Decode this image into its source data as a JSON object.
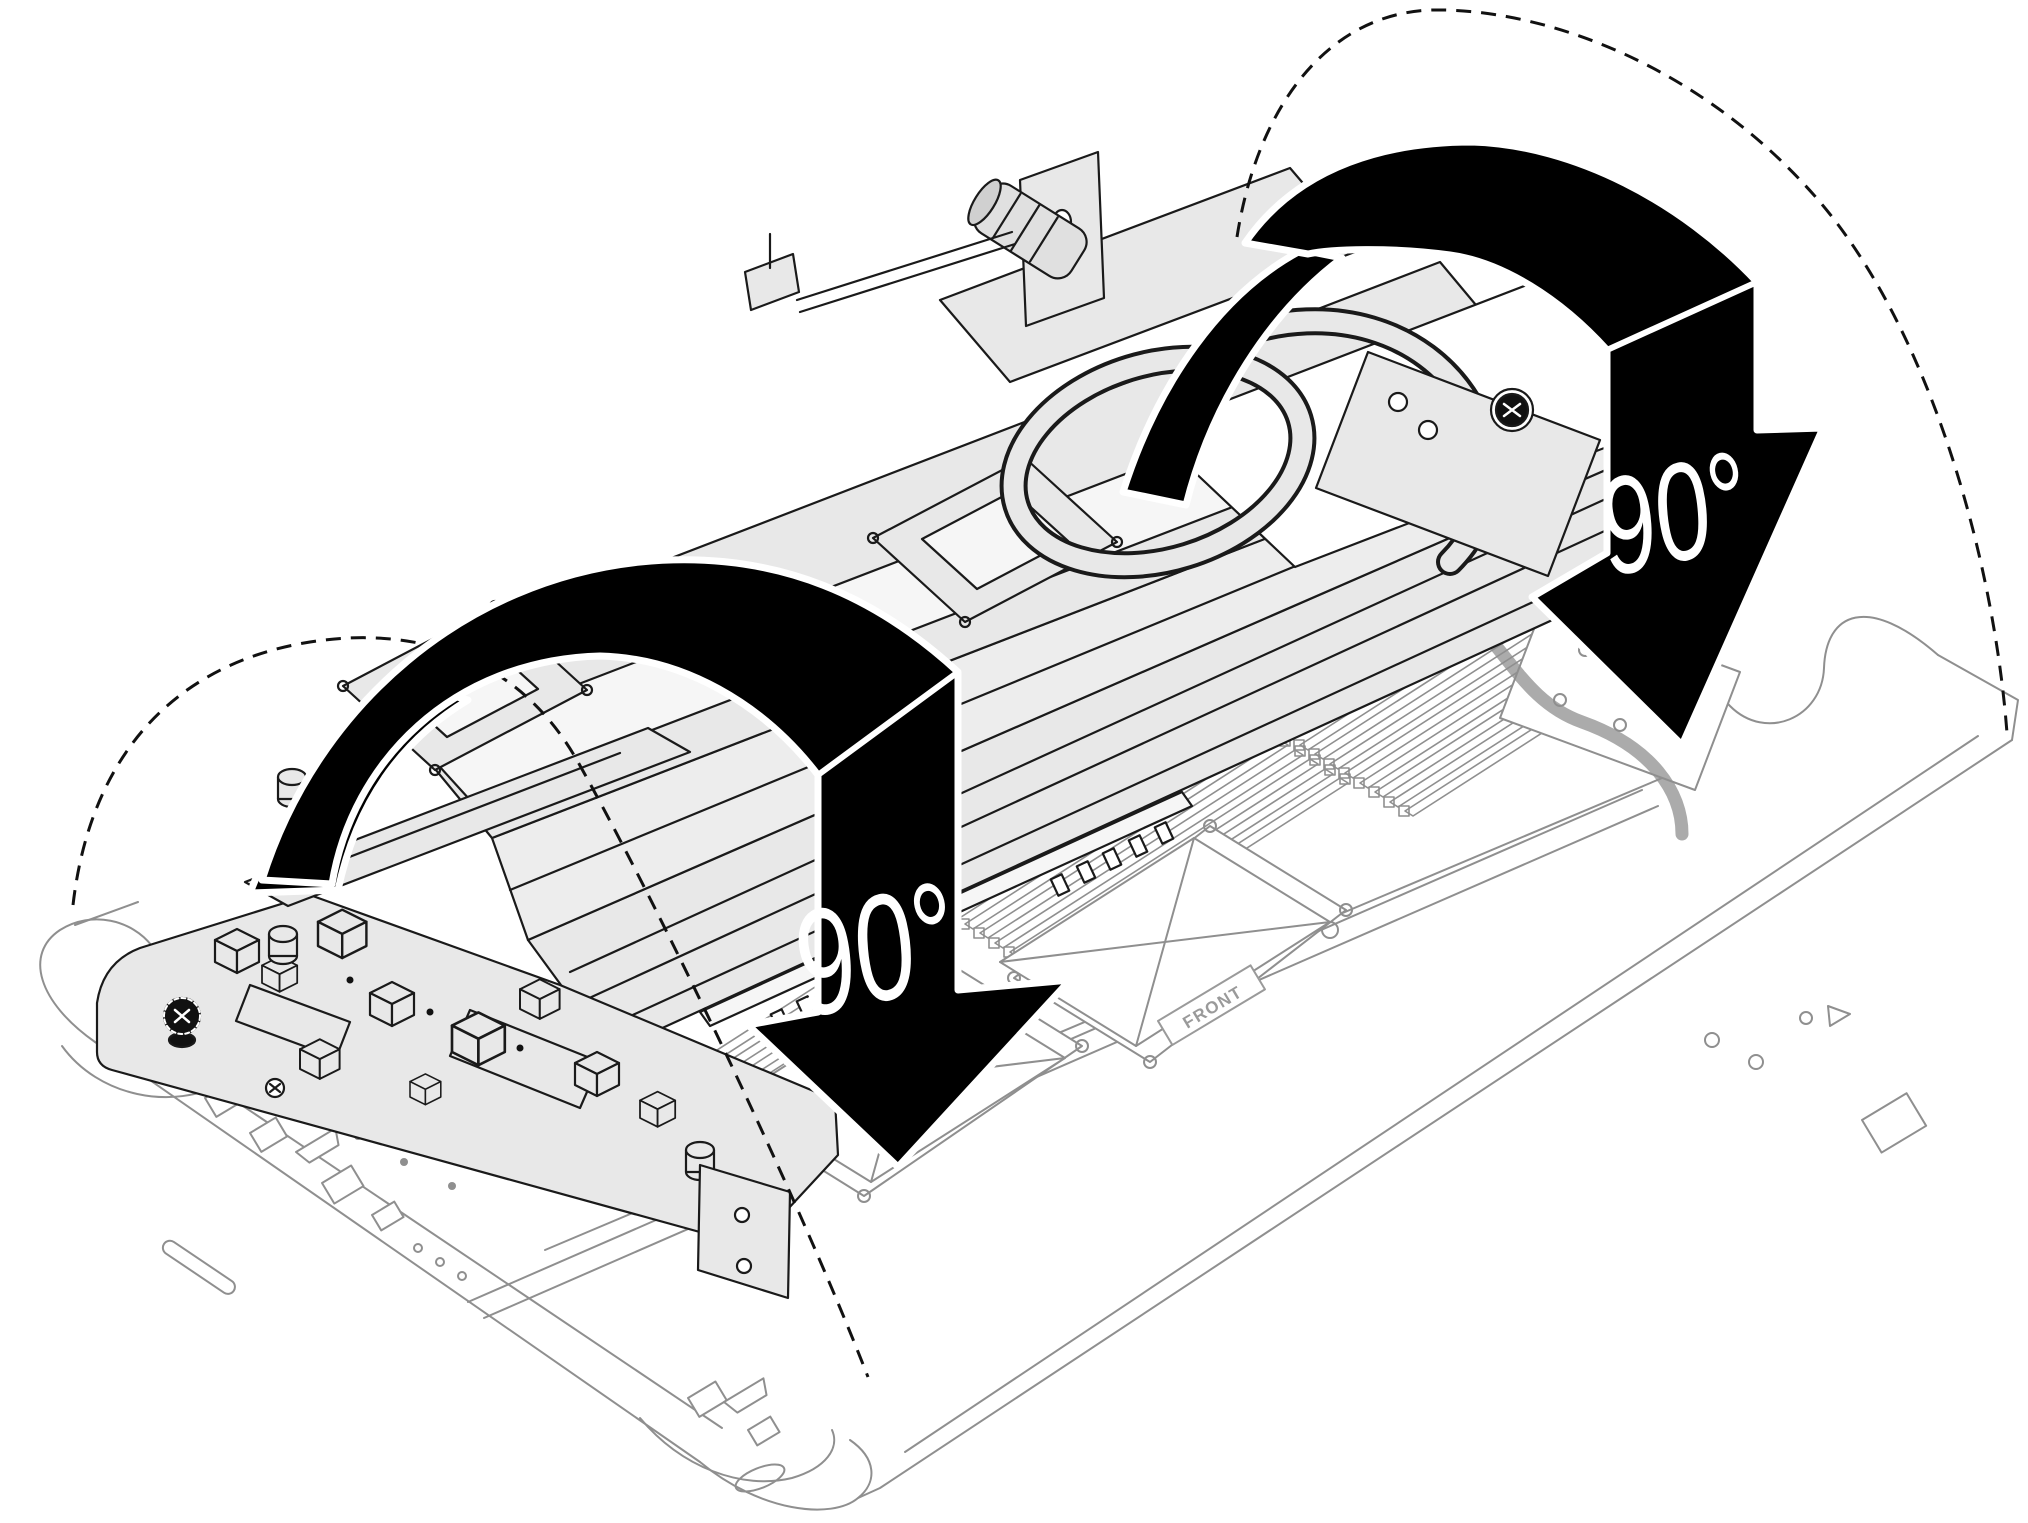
{
  "illustration": {
    "title": "Rotate the water loop assembly 90 degrees onto the system board tray",
    "scene": "isometric-technical-line-art",
    "background_color": "#ffffff",
    "labels": {
      "rotation_left": "90°",
      "rotation_right": "90°",
      "board_front": "FRONT"
    },
    "colors": {
      "chassis_line": "#8f8f8f",
      "assembly_line": "#1a1a1a",
      "assembly_fill": "#e8e8e8",
      "arrow_fill": "#000000",
      "arrow_outline": "#ffffff",
      "rotation_label_color": "#ffffff",
      "front_label_color": "#9a9a9a",
      "dashed_path_color": "#111111"
    }
  }
}
